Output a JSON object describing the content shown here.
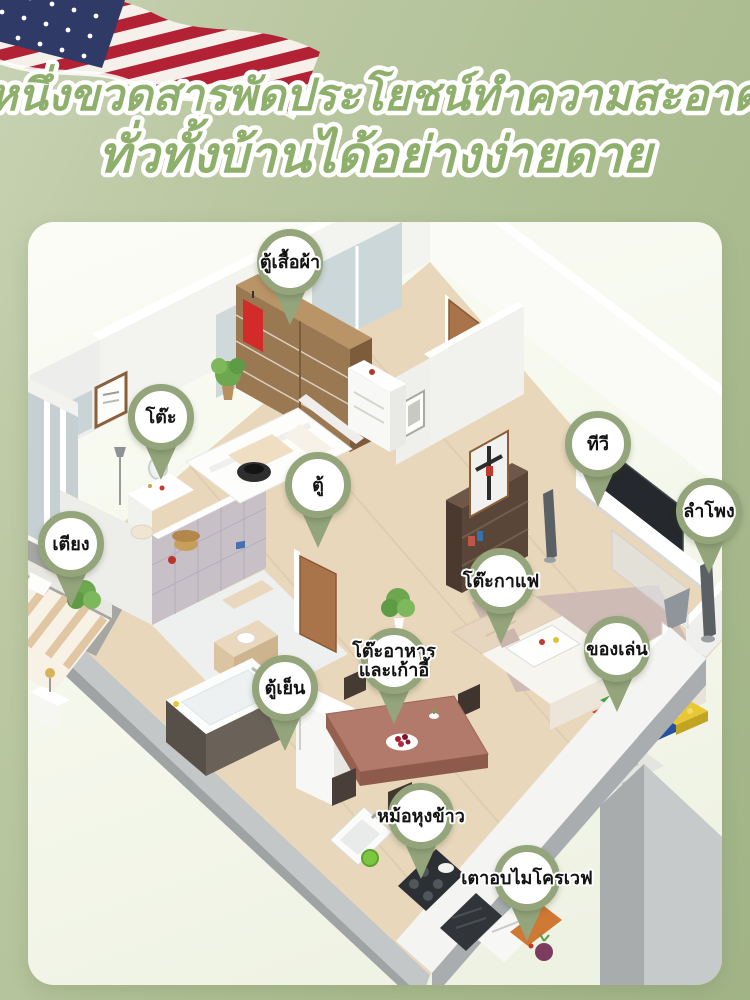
{
  "page": {
    "background_color": "#aebf93",
    "card_color": "#f5f8ec"
  },
  "header": {
    "line1": "หนึ่งขวดสารพัดประโยชน์ทำความสะอาด",
    "line2": "ทั่วทั้งบ้านได้อย่างง่ายดาย",
    "text_color": "#8fb06c",
    "outline_color": "#ffffff"
  },
  "flag": {
    "name": "us-flag",
    "stripe_red": "#b22234",
    "stripe_white": "#f5f1ea",
    "canton_blue": "#303a66"
  },
  "floorplan": {
    "pin_color": "#94a57c",
    "pin_text_color": "#131313",
    "pins": [
      {
        "id": "wardrobe",
        "label": "ตู้เสื้อผ้า"
      },
      {
        "id": "table",
        "label": "โต๊ะ"
      },
      {
        "id": "cabinet",
        "label": "ตู้"
      },
      {
        "id": "tv",
        "label": "ทีวี"
      },
      {
        "id": "speaker",
        "label": "ลำโพง"
      },
      {
        "id": "bed",
        "label": "เตียง"
      },
      {
        "id": "coffee-table",
        "label": "โต๊ะกาแฟ"
      },
      {
        "id": "dining-table-chairs",
        "label": "โต๊ะอาหาร\nและเก้าอี้"
      },
      {
        "id": "toys",
        "label": "ของเล่น"
      },
      {
        "id": "fridge",
        "label": "ตู้เย็น"
      },
      {
        "id": "rice-cooker",
        "label": "หม้อหุงข้าว"
      },
      {
        "id": "microwave",
        "label": "เตาอบไมโครเวฟ"
      }
    ]
  }
}
